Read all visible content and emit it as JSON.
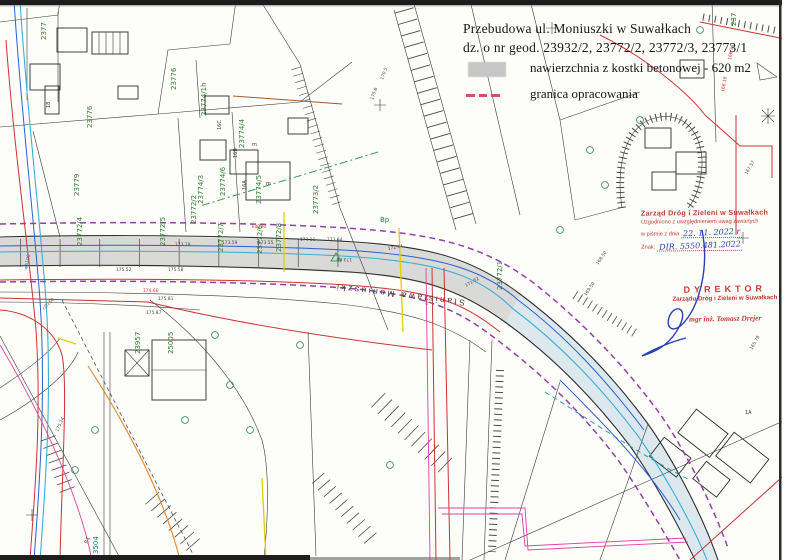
{
  "title": {
    "line1": "Przebudowa ul. Moniuszki w Suwałkach",
    "line2": "dz. o nr geod. 23932/2, 23772/2, 23772/3, 23773/1"
  },
  "legend": {
    "pavement_label": "nawierzchnia z kostki betonowej - 620 m2",
    "boundary_label": "granica opracowania"
  },
  "approval_stamp": {
    "org": "Zarząd Dróg i Zieleni w Suwałkach",
    "line2": "Uzgodniono z uwzględnieniem uwag zawartych",
    "date_prefix": "w piśmie z dnia",
    "date_value": "22. 11. 2022 r",
    "ref_prefix": "Znak:",
    "ref_value": "DIR. 5550.481.2022"
  },
  "director_stamp": {
    "title": "DYREKTOR",
    "org": "Zarządu Dróg i Zieleni w Suwałkach",
    "name": "mgr inż. Tomasz Drejer"
  },
  "map": {
    "street_label": "Stanisława Moniuszki",
    "parcel_labels": [
      "2377",
      "23776",
      "23779",
      "23776",
      "23774/1h",
      "23774/4",
      "23774/3",
      "23774/6",
      "23774/5",
      "23773/2",
      "23772/2",
      "23772/7",
      "23772/6",
      "23772/8",
      "23772/4",
      "23772/5",
      "23772/1",
      "23957",
      "25005",
      "3504",
      "237"
    ],
    "building_labels": [
      "16C",
      "16B",
      "16A",
      "m",
      "m",
      "1A",
      "18",
      "P.1",
      "Bp"
    ],
    "elevations": [
      "173.19",
      "173.59",
      "173.55",
      "173.11",
      "173.64",
      "172.84",
      "171.52",
      "175.58",
      "175.52",
      "174.66",
      "175.81",
      "175.87",
      "170.5",
      "175.8",
      "166.34",
      "166.19",
      "167.57",
      "168.50",
      "169.50",
      "165.78",
      "175.24",
      "173.66"
    ],
    "utility_labels": [
      "wA100",
      "cD150",
      "kd200",
      "eNN"
    ],
    "colors": {
      "boundary_dash": "#9340a8",
      "water_blue": "#2a5fd0",
      "cyan": "#38b0d5",
      "red": "#cc3333",
      "magenta": "#e040a8",
      "yellow": "#e3cf00",
      "orange": "#e08a2a",
      "parcel_green": "#2e7d32",
      "teal": "#2a9d8f",
      "pavement_gray": "#c4c4c4"
    }
  }
}
